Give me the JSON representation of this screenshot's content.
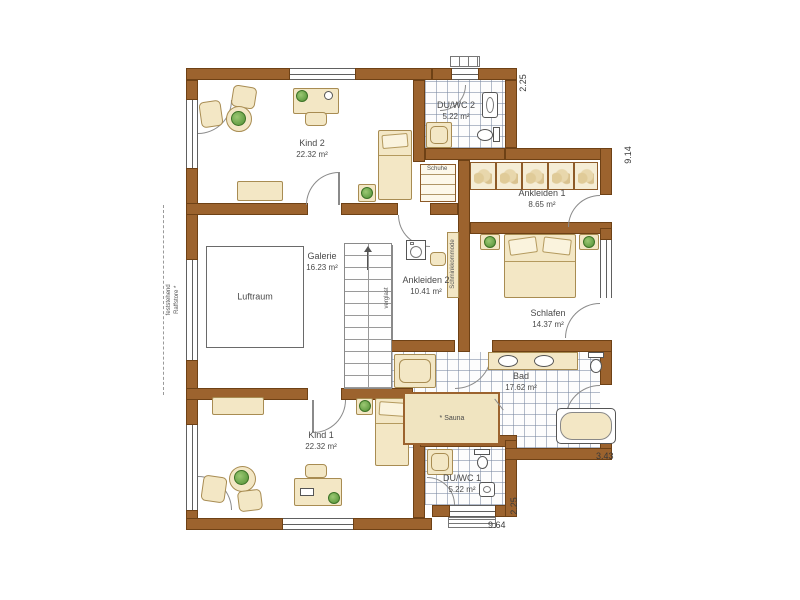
{
  "drawing_type": "floor-plan-upper-storey",
  "rooms": {
    "kind2": {
      "name": "Kind 2",
      "area": "22.32 m²"
    },
    "duwc2": {
      "name": "DU/WC 2",
      "area": "5.22 m²"
    },
    "ankleiden1": {
      "name": "Ankleiden 1",
      "area": "8.65 m²"
    },
    "ankleiden2": {
      "name": "Ankleiden 2",
      "area": "10.41 m²"
    },
    "galerie": {
      "name": "Galerie",
      "area": "16.23 m²"
    },
    "luftraum": {
      "name": "Luftraum"
    },
    "schlafen": {
      "name": "Schlafen",
      "area": "14.37 m²"
    },
    "bad": {
      "name": "Bad",
      "area": "17.62 m²"
    },
    "kind1": {
      "name": "Kind 1",
      "area": "22.32 m²"
    },
    "duwc1": {
      "name": "DU/WC 1",
      "area": "5.22 m²"
    }
  },
  "annotations": {
    "sauna": "* Sauna",
    "schuhe": "Schuhe",
    "schminkkommode": "Schminkkommode",
    "raffstore_line1": "feststehend",
    "raffstore_line2": "Raffstore *",
    "stair_glazing": "verglast"
  },
  "dimensions": {
    "top_right": "2.25",
    "right_side": "9.14",
    "terrace_right": "3.43",
    "bottom_width": "9.64",
    "bottom_side": "2.25"
  },
  "colors": {
    "wall": "#9c632e",
    "furniture": "#f3e7c5",
    "tile_line": "#8291a5",
    "plant": "#4f8f33",
    "text": "#4a4a4a"
  }
}
